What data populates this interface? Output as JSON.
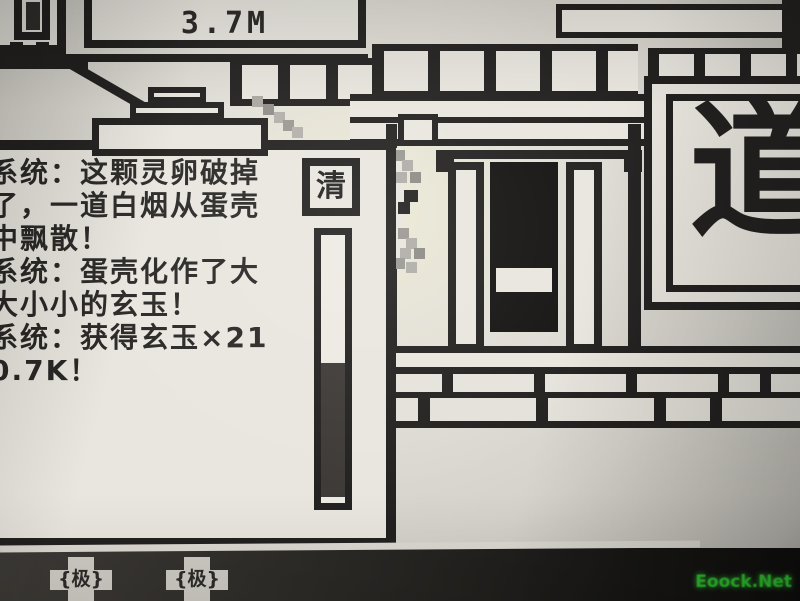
{
  "hud": {
    "counter": "3.7M"
  },
  "message_panel": {
    "lines": [
      "系统：这颗灵卵破掉",
      "了，一道白烟从蛋壳",
      "中飘散！",
      "系统：蛋壳化作了大",
      "大小小的玄玉！",
      "系统：获得玄玉×21",
      "0.7K！"
    ],
    "clear_button_label": "清"
  },
  "plaque": {
    "character": "道"
  },
  "footer": {
    "badges": [
      {
        "label": "{极}"
      },
      {
        "label": "{极}"
      }
    ],
    "watermark": "Eoock.Net"
  },
  "colors": {
    "ink": "#232120",
    "paper": "#e9e6df",
    "screen": "#d7d4cd",
    "scrollbar_thumb": "#3c3936",
    "watermark_green": "#2fc42f"
  }
}
